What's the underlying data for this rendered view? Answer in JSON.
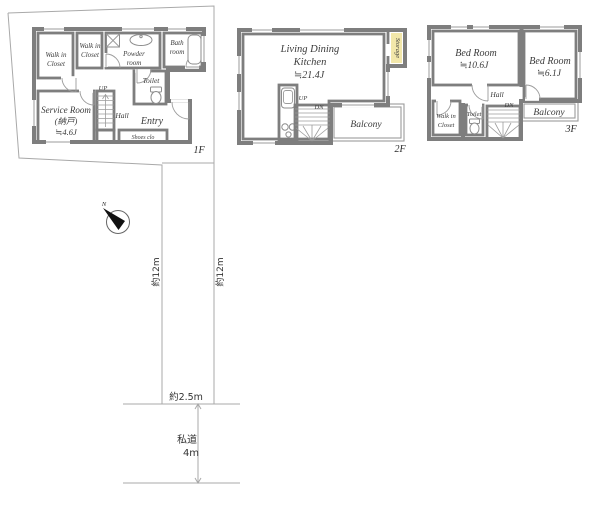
{
  "colors": {
    "wall": "#7e7e7e",
    "yellow": "#f2e7aa",
    "cyan": "#cfe8ec",
    "pink": "#f6dbd5",
    "tan": "#e9dabd",
    "tan2": "#e9d6c6",
    "white": "#ffffff",
    "line": "#a9a9a9",
    "needle": "#111111"
  },
  "floor1": {
    "label": "1F",
    "wic1_line1": "Walk in",
    "wic1_line2": "Closet",
    "wic2_line1": "Walk in",
    "wic2_line2": "Closet",
    "powder_line1": "Powder",
    "powder_line2": "room",
    "bath_line1": "Bath",
    "bath_line2": "room",
    "toilet": "Toilet",
    "service_line1": "Service Room",
    "service_line2": "(納戸)",
    "service_line3": "≒4.6J",
    "up": "UP",
    "hall": "Hall",
    "entry": "Entry",
    "shoes": "Shoes clo"
  },
  "floor2": {
    "label": "2F",
    "ldk_line1": "Living Dining",
    "ldk_line2": "Kitchen",
    "ldk_line3": "≒21.4J",
    "storage": "Storage",
    "up": "UP",
    "dn": "DN",
    "balcony": "Balcony"
  },
  "floor3": {
    "label": "3F",
    "bed1_line1": "Bed Room",
    "bed1_line2": "≒10.6J",
    "bed2_line1": "Bed Room",
    "bed2_line2": "≒6.1J",
    "hall": "Hall",
    "dn": "DN",
    "wic_line1": "Walk in",
    "wic_line2": "Closet",
    "toilet": "Toilet",
    "balcony": "Balcony"
  },
  "site": {
    "north": "N",
    "dim_left": "約12m",
    "dim_right": "約12m",
    "dim_front": "約2.5m",
    "road_line1": "私道",
    "road_line2": "4m"
  }
}
